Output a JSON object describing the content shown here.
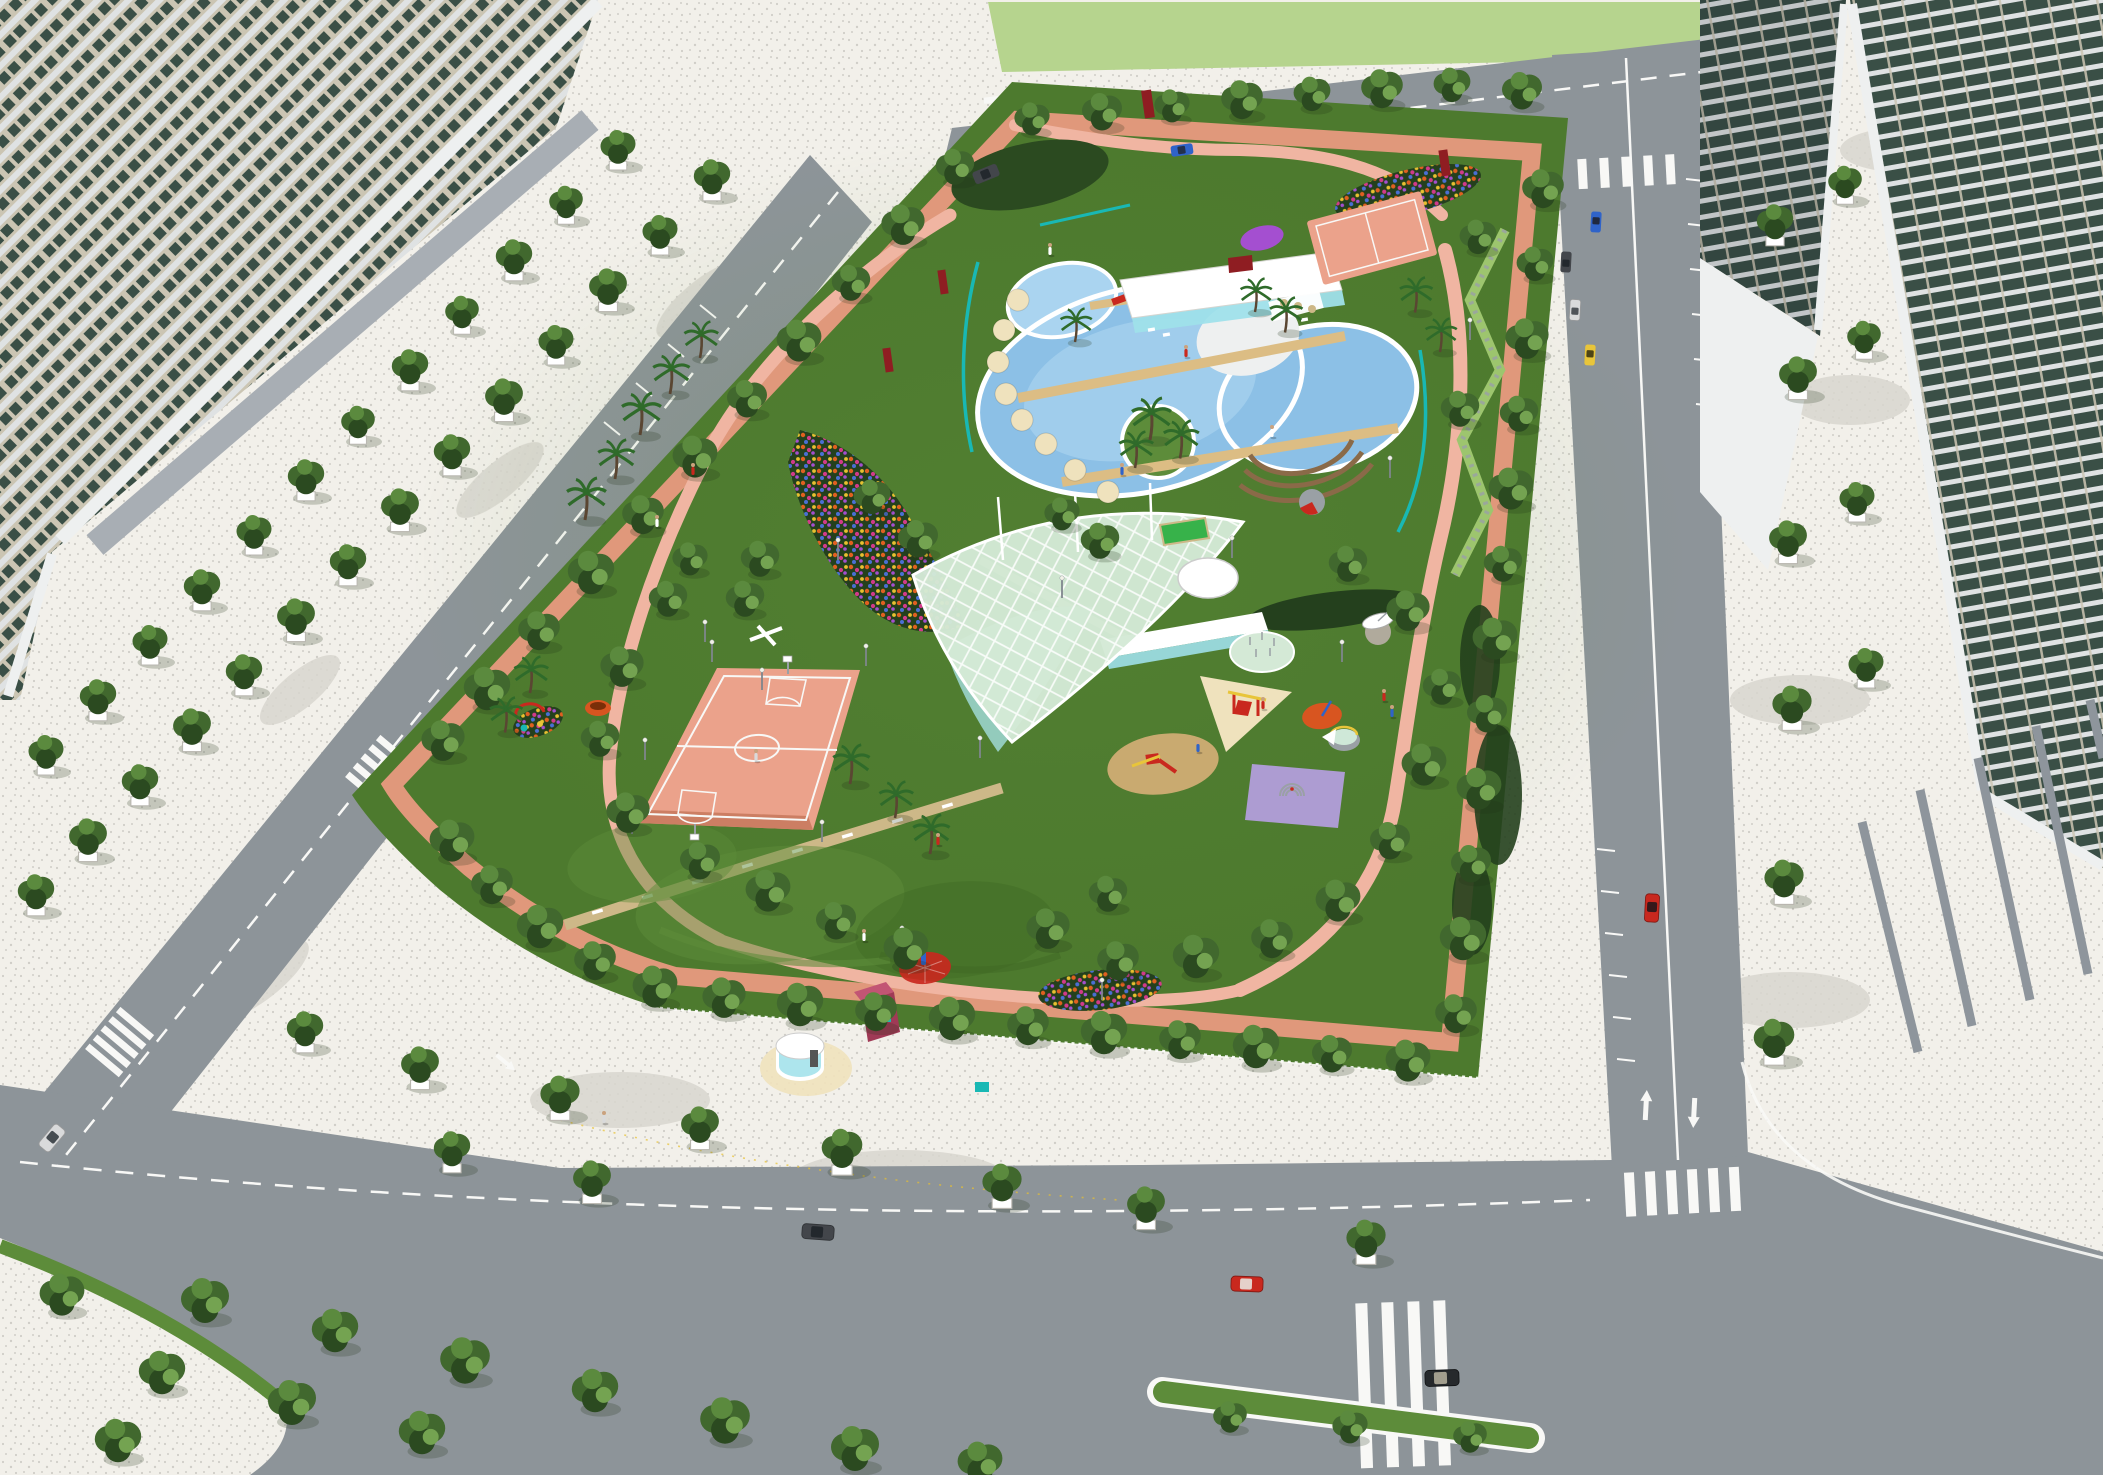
{
  "meta": {
    "title": "Community Park Master Plan — Aerial 3D Rendering",
    "description": "Bird's-eye architectural rendering of a rectangular urban park surrounded by streets and residential high-rise towers. The park contains a kidney-shaped swimming pool with pool house, a leaf-shaped tensile canopy, a basketball court, playgrounds, flower gardens, lawns with mounds, looping salmon-colored paths and dense perimeter trees."
  },
  "colors": {
    "pavement": "#f2f0ea",
    "speckle": "#c7c5bf",
    "mottle": "#d9d6cf",
    "road": "#8d9499",
    "marking": "#f8f8f6",
    "grass": "#4d7a2e",
    "grass2": "#5d8c3a",
    "grass3": "#3f6823",
    "field": "#b6d48e",
    "pathgreen": "#9dc56e",
    "tree1": "#2b4a20",
    "tree2": "#41682e",
    "tree3": "#5b8a3e",
    "tree4": "#74a351",
    "trunk": "#5a4632",
    "palm": "#2f6b2a",
    "hedge": "#24401d",
    "shadow": "#1e3316",
    "pink": "#e89a80",
    "pink2": "#f0b5a2",
    "tan": "#cdb888",
    "deck": "#dcbd84",
    "yellowpath": "#ead9a6",
    "pool": "#8cc0e6",
    "pool2": "#aad4f0",
    "white": "#ffffff",
    "offwhite": "#eef0f0",
    "glass": "#9fe0ea",
    "teal": "#19b8b4",
    "beige": "#cbc5b3",
    "win": "#3a4f46",
    "band": "#dfe2e3",
    "podium": "#a8aeb4",
    "pilotis": "#8e959c",
    "court": "#eba28b",
    "court2": "#c97a5e",
    "canopy": "#d4e9d6",
    "canteal": "#9ad4cc",
    "green": "#37b24a",
    "sand": "#c9aa70",
    "purple": "#ad9cd2",
    "orange": "#d85520",
    "cream": "#efe2bd",
    "maroon": "#a03a56",
    "darkred": "#8f1d22",
    "red": "#c9281e",
    "yellow": "#e8c53a",
    "blue": "#2f63c9",
    "silver": "#d9dadb",
    "black": "#26292c",
    "darkgray": "#43464b",
    "gray": "#9aa0a5",
    "stone": "#b0aa9c",
    "wood": "#8a6a48",
    "flower1": "#e06020",
    "flower2": "#d23a8a",
    "flower3": "#4a6fd4",
    "flower4": "#e8c030",
    "flower5": "#a44fd0"
  },
  "scene": {
    "setting": "Daytime aerial view, rectangular community park bounded by four streets, high-rise residential slabs at top-left and right, light-green field beyond the top street",
    "park_features": [
      {
        "name": "swimming-pool-complex",
        "detail": "kidney-shaped blue pool, children's pool with red-and-white mushroom fountain and red slide, palm island, timber decks crossing the water"
      },
      {
        "name": "pool-house",
        "detail": "flat white roof pavilion with aqua glass front and dark red rooftop volume"
      },
      {
        "name": "amphitheater-steps",
        "detail": "curved timber seating tiers south-east of the pool"
      },
      {
        "name": "tensile-canopy",
        "detail": "leaf-shaped pale green membrane with white cable grid over a sunken glass pavilion"
      },
      {
        "name": "basketball-court",
        "detail": "salmon acrylic court with white markings, hoops and light poles"
      },
      {
        "name": "practice-court",
        "detail": "small salmon court at the north-east corner"
      },
      {
        "name": "children-playground",
        "detail": "red and yellow swing and slide sets on cream triangle pad, sand ellipse, purple play mat with dome climber, orange toddler circle, splash pad, round planter pool"
      },
      {
        "name": "flower-gardens",
        "detail": "multicolor flower masses along the north-west path, north-east corner and south lawn"
      },
      {
        "name": "grass-mounds",
        "detail": "sculpted lawn hills in the southern meadow"
      },
      {
        "name": "jogging-loop",
        "detail": "salmon-pink perimeter loop and inner curving paths"
      },
      {
        "name": "boardwalk",
        "detail": "tan stepping path with low white seat walls crossing the south lawn"
      },
      {
        "name": "round-kiosk",
        "detail": "white cylindrical glass kiosk on cream apron near the south plaza"
      },
      {
        "name": "maroon-kiosk",
        "detail": "small crimson service building"
      },
      {
        "name": "sculptures",
        "detail": "dark red monoliths, white dish sculpture, orange bowl, red circular pad with blue figure"
      }
    ],
    "streets": {
      "elements": [
        "zebra crosswalks",
        "dashed lane lines",
        "up and down lane arrows on the east street",
        "parking bays",
        "green median with trees on the south street",
        "rounded curb corners"
      ],
      "vehicles": [
        {
          "type": "sedan",
          "color": "white",
          "location": "west street"
        },
        {
          "type": "van",
          "color": "dark gray",
          "location": "north-west bend"
        },
        {
          "type": "van",
          "color": "blue",
          "location": "north street"
        },
        {
          "type": "sedan",
          "color": "blue",
          "location": "east street"
        },
        {
          "type": "sedan",
          "color": "dark gray",
          "location": "east street"
        },
        {
          "type": "sedan",
          "color": "white",
          "location": "east street"
        },
        {
          "type": "sedan",
          "color": "yellow",
          "location": "east street"
        },
        {
          "type": "sedan",
          "color": "red",
          "location": "east street"
        },
        {
          "type": "sedan",
          "color": "dark gray",
          "location": "south street"
        },
        {
          "type": "sedan",
          "color": "red",
          "location": "south street parking"
        },
        {
          "type": "sedan",
          "color": "black",
          "location": "south-east crosswalk"
        }
      ]
    },
    "buildings": [
      {
        "name": "residential-slab-west",
        "detail": "long beige tower with dark teal windows, white floor bands, gray podium canopy, double row of street trees"
      },
      {
        "name": "residential-tower-east-near",
        "detail": "tall slab with teal glass, white balcony bands and pilotis columns"
      },
      {
        "name": "residential-tower-east-far",
        "detail": "second slab behind a white podium wedge"
      }
    ],
    "vegetation": {
      "street_trees": "round canopies in white planters",
      "park_trees": "dense perimeter rows and scattered groves",
      "palms": "around pool and west lawn",
      "hedges": "dark clipped masses and tall grass strips"
    }
  }
}
